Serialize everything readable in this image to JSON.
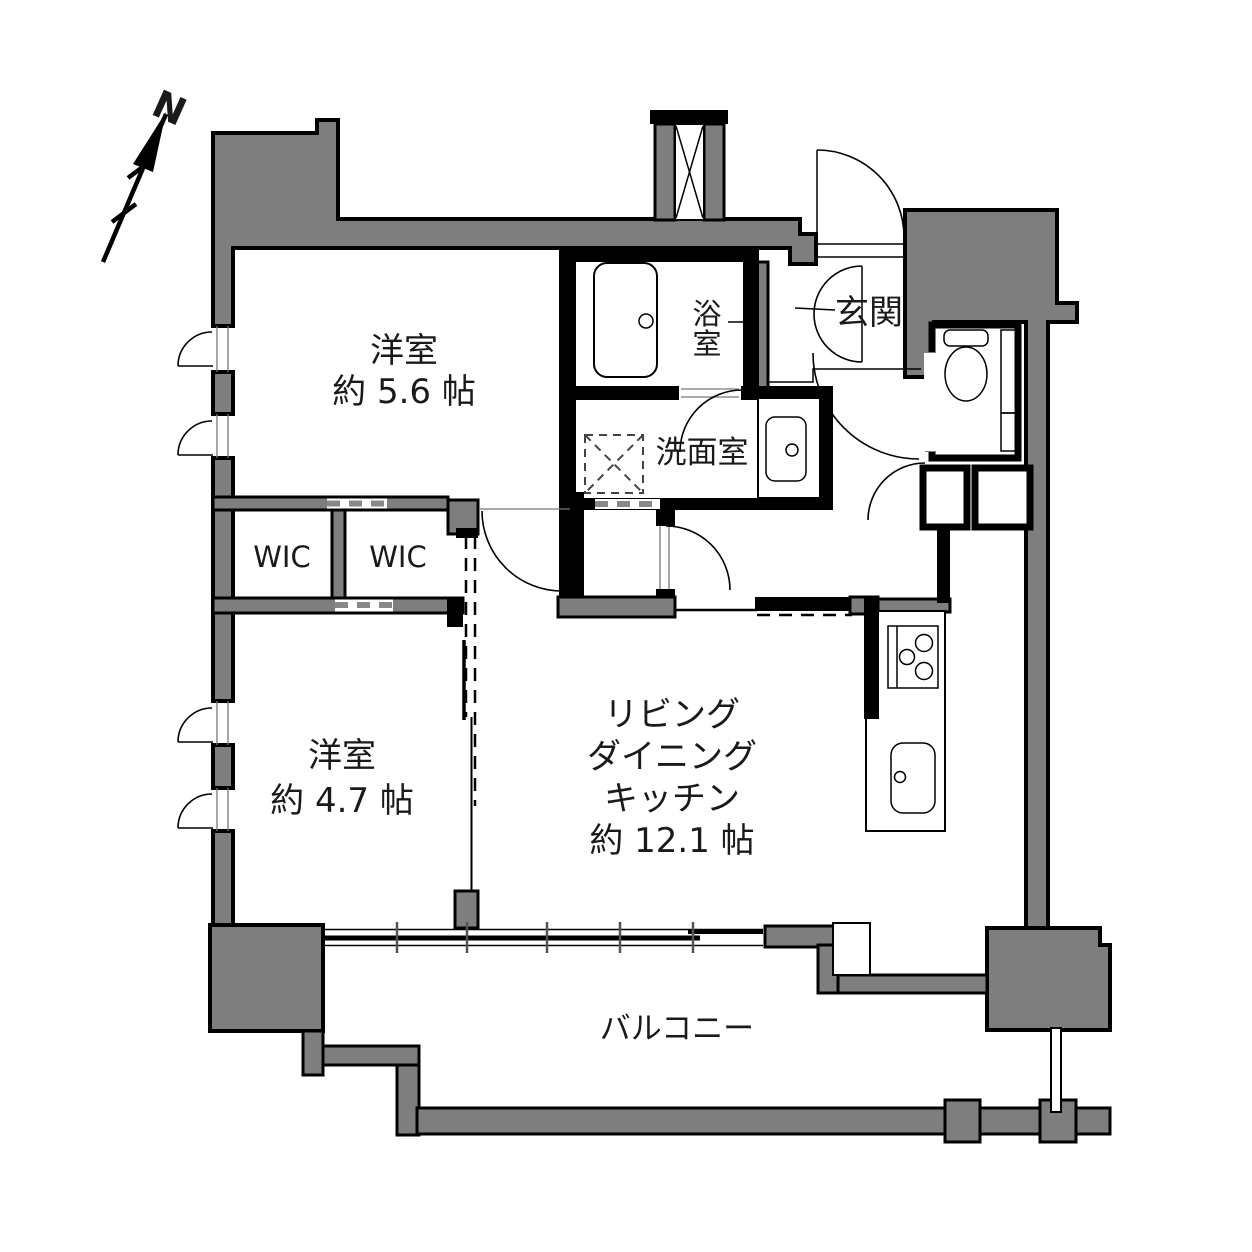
{
  "compass": {
    "north_label": "N"
  },
  "rooms": {
    "bedroom1": {
      "name": "洋室",
      "size": "約 5.6 帖"
    },
    "bedroom2": {
      "name": "洋室",
      "size": "約 4.7 帖"
    },
    "ldk": {
      "line1": "リビング",
      "line2": "ダイニング",
      "line3": "キッチン",
      "size": "約 12.1 帖"
    },
    "wic1": {
      "name": "WIC"
    },
    "wic2": {
      "name": "WIC"
    },
    "bathroom": {
      "char1": "浴",
      "char2": "室"
    },
    "washroom": {
      "name": "洗面室"
    },
    "entrance": {
      "name": "玄関"
    },
    "balcony": {
      "name": "バルコニー"
    }
  },
  "colors": {
    "wall_gray": "#7e7e7e",
    "wall_black": "#000000",
    "background": "#ffffff"
  }
}
